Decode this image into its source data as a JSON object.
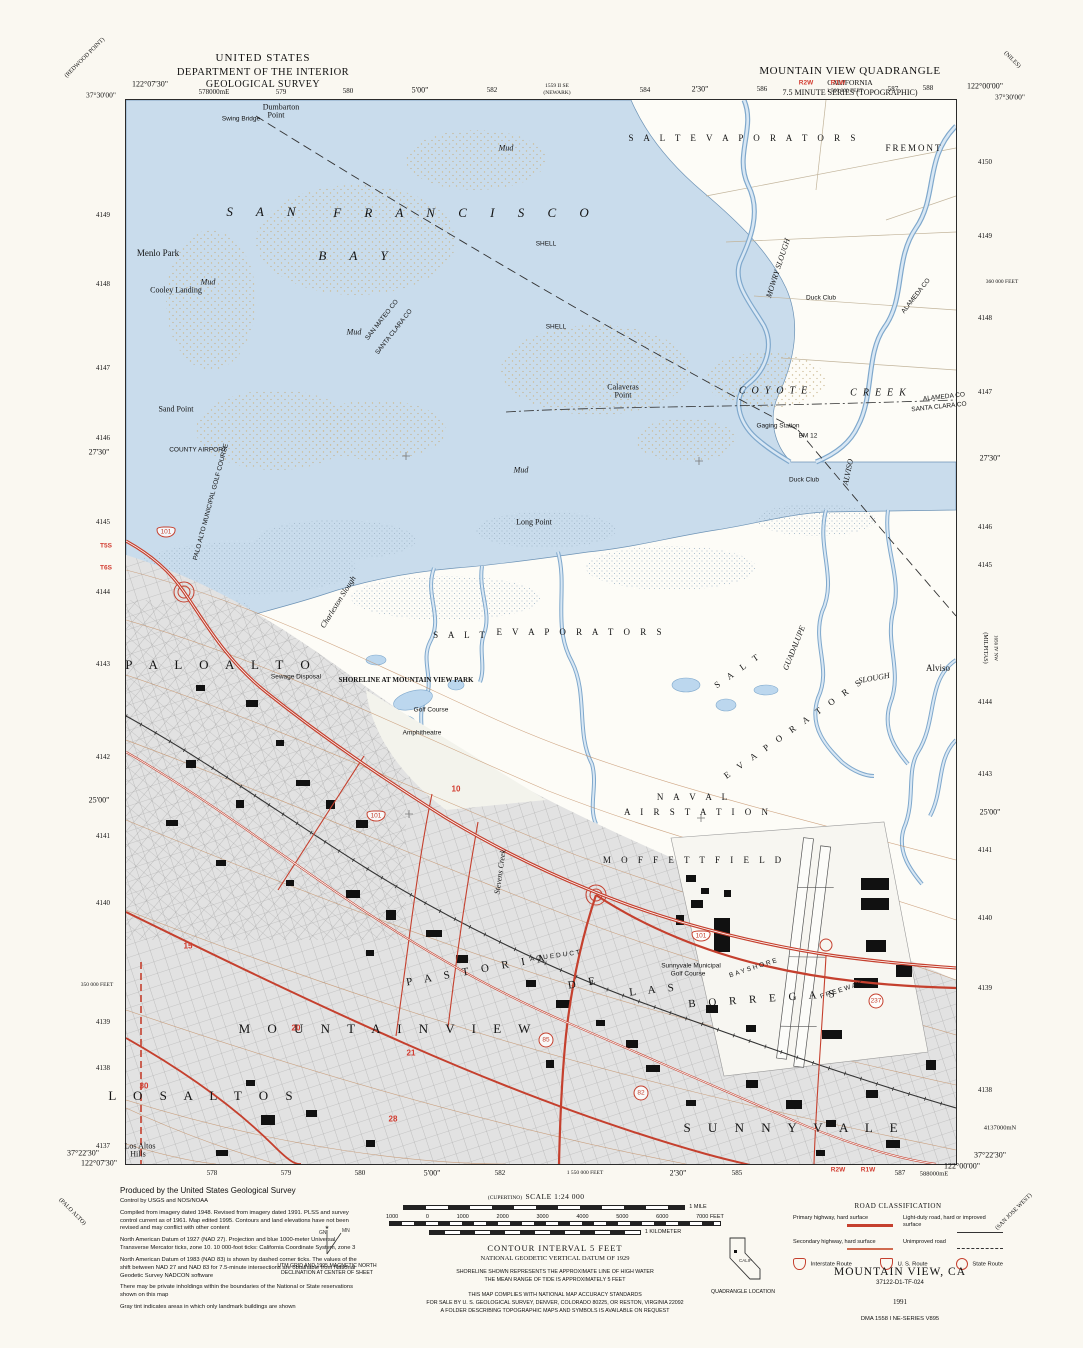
{
  "header": {
    "line1": "UNITED STATES",
    "line2": "DEPARTMENT OF THE INTERIOR",
    "line3": "GEOLOGICAL SURVEY"
  },
  "title_block": {
    "line1": "MOUNTAIN VIEW QUADRANGLE",
    "line2": "CALIFORNIA",
    "line3": "7.5 MINUTE SERIES (TOPOGRAPHIC)"
  },
  "colors": {
    "water": "#c9dcec",
    "marsh_dot": "#9fb4c8",
    "urban_tint": "#e2e2e2",
    "road_red": "#c5402e",
    "contour_brown": "#c08a5f",
    "label_red": "#d23b2f"
  },
  "margin_labels": [
    {
      "t": "122°07'30\"",
      "x": 150,
      "y": 84
    },
    {
      "t": "37°30'00\"",
      "x": 101,
      "y": 95,
      "s": 7.5
    },
    {
      "t": "578000mE",
      "x": 214,
      "y": 92,
      "s": 7
    },
    {
      "t": "579",
      "x": 281,
      "y": 92,
      "s": 7
    },
    {
      "t": "580",
      "x": 348,
      "y": 91,
      "s": 7
    },
    {
      "t": "5'00\"",
      "x": 420,
      "y": 90
    },
    {
      "t": "582",
      "x": 492,
      "y": 90,
      "s": 7
    },
    {
      "t": "1559 II SE",
      "x": 557,
      "y": 86,
      "s": 5.5
    },
    {
      "t": "(NEWARK)",
      "x": 557,
      "y": 93,
      "s": 5.5
    },
    {
      "t": "584",
      "x": 645,
      "y": 90,
      "s": 7
    },
    {
      "t": "2'30\"",
      "x": 700,
      "y": 89
    },
    {
      "t": "586",
      "x": 762,
      "y": 89,
      "s": 7
    },
    {
      "t": "R2W",
      "x": 806,
      "y": 83,
      "red": 1,
      "s": 6.5
    },
    {
      "t": "R1W",
      "x": 838,
      "y": 83,
      "red": 1,
      "s": 6.5
    },
    {
      "t": "1 560 000 FEET",
      "x": 845,
      "y": 91,
      "s": 5.5
    },
    {
      "t": "587",
      "x": 893,
      "y": 89,
      "s": 7
    },
    {
      "t": "588",
      "x": 928,
      "y": 88,
      "s": 7
    },
    {
      "t": "122°00'00\"",
      "x": 985,
      "y": 86
    },
    {
      "t": "37°30'00\"",
      "x": 1010,
      "y": 97,
      "s": 7.5
    },
    {
      "t": "4149",
      "x": 103,
      "y": 215,
      "s": 7
    },
    {
      "t": "4148",
      "x": 103,
      "y": 284,
      "s": 7
    },
    {
      "t": "4147",
      "x": 103,
      "y": 368,
      "s": 7
    },
    {
      "t": "4146",
      "x": 103,
      "y": 438,
      "s": 7
    },
    {
      "t": "27'30\"",
      "x": 99,
      "y": 452
    },
    {
      "t": "4145",
      "x": 103,
      "y": 522,
      "s": 7
    },
    {
      "t": "T5S",
      "x": 106,
      "y": 546,
      "red": 1,
      "s": 6.5
    },
    {
      "t": "T6S",
      "x": 106,
      "y": 568,
      "red": 1,
      "s": 6.5
    },
    {
      "t": "4144",
      "x": 103,
      "y": 592,
      "s": 7
    },
    {
      "t": "4143",
      "x": 103,
      "y": 664,
      "s": 7
    },
    {
      "t": "4142",
      "x": 103,
      "y": 757,
      "s": 7
    },
    {
      "t": "25'00\"",
      "x": 99,
      "y": 800
    },
    {
      "t": "4141",
      "x": 103,
      "y": 836,
      "s": 7
    },
    {
      "t": "4140",
      "x": 103,
      "y": 903,
      "s": 7
    },
    {
      "t": "350 000 FEET",
      "x": 97,
      "y": 985,
      "s": 5.5
    },
    {
      "t": "4139",
      "x": 103,
      "y": 1022,
      "s": 7
    },
    {
      "t": "4138",
      "x": 103,
      "y": 1068,
      "s": 7
    },
    {
      "t": "4137",
      "x": 103,
      "y": 1146,
      "s": 7
    },
    {
      "t": "37°22'30\"",
      "x": 83,
      "y": 1153
    },
    {
      "t": "122°07'30\"",
      "x": 99,
      "y": 1163
    },
    {
      "t": "4150",
      "x": 985,
      "y": 162,
      "s": 7
    },
    {
      "t": "4149",
      "x": 985,
      "y": 236,
      "s": 7
    },
    {
      "t": "360 000 FEET",
      "x": 1002,
      "y": 282,
      "s": 5.5
    },
    {
      "t": "4148",
      "x": 985,
      "y": 318,
      "s": 7
    },
    {
      "t": "4147",
      "x": 985,
      "y": 392,
      "s": 7
    },
    {
      "t": "27'30\"",
      "x": 990,
      "y": 458
    },
    {
      "t": "4146",
      "x": 985,
      "y": 527,
      "s": 7
    },
    {
      "t": "4145",
      "x": 985,
      "y": 565,
      "s": 7
    },
    {
      "t": "(MILPITAS)",
      "x": 985,
      "y": 648,
      "r": 90,
      "s": 6
    },
    {
      "t": "1656 IV NW",
      "x": 995,
      "y": 648,
      "r": 90,
      "s": 5
    },
    {
      "t": "4144",
      "x": 985,
      "y": 702,
      "s": 7
    },
    {
      "t": "4143",
      "x": 985,
      "y": 774,
      "s": 7
    },
    {
      "t": "25'00\"",
      "x": 990,
      "y": 812
    },
    {
      "t": "4141",
      "x": 985,
      "y": 850,
      "s": 7
    },
    {
      "t": "4140",
      "x": 985,
      "y": 918,
      "s": 7
    },
    {
      "t": "4139",
      "x": 985,
      "y": 988,
      "s": 7
    },
    {
      "t": "4138",
      "x": 985,
      "y": 1090,
      "s": 7
    },
    {
      "t": "4137000mN",
      "x": 1000,
      "y": 1128,
      "s": 6.5
    },
    {
      "t": "37°22'30\"",
      "x": 990,
      "y": 1155
    },
    {
      "t": "122°00'00\"",
      "x": 962,
      "y": 1166
    },
    {
      "t": "578",
      "x": 212,
      "y": 1173,
      "s": 7
    },
    {
      "t": "579",
      "x": 286,
      "y": 1173,
      "s": 7
    },
    {
      "t": "580",
      "x": 360,
      "y": 1173,
      "s": 7
    },
    {
      "t": "5'00\"",
      "x": 432,
      "y": 1173
    },
    {
      "t": "582",
      "x": 500,
      "y": 1173,
      "s": 7
    },
    {
      "t": "1 550 000 FEET",
      "x": 585,
      "y": 1173,
      "s": 5.5
    },
    {
      "t": "2'30\"",
      "x": 678,
      "y": 1173
    },
    {
      "t": "585",
      "x": 737,
      "y": 1173,
      "s": 7
    },
    {
      "t": "R2W",
      "x": 838,
      "y": 1170,
      "red": 1,
      "s": 6.5
    },
    {
      "t": "R1W",
      "x": 868,
      "y": 1170,
      "red": 1,
      "s": 6.5
    },
    {
      "t": "587",
      "x": 900,
      "y": 1173,
      "s": 7
    },
    {
      "t": "588000mE",
      "x": 934,
      "y": 1174,
      "s": 6.5
    },
    {
      "t": "(CUPERTINO)",
      "x": 505,
      "y": 1198,
      "s": 5.5
    },
    {
      "t": "(REDWOOD POINT)",
      "x": 85,
      "y": 58,
      "r": -45,
      "s": 6
    },
    {
      "t": "(NILES)",
      "x": 1012,
      "y": 60,
      "r": 45,
      "s": 6
    },
    {
      "t": "(SAN JOSE WEST)",
      "x": 1014,
      "y": 1212,
      "r": -45,
      "s": 6
    },
    {
      "t": "(PALO ALTO)",
      "x": 72,
      "y": 1212,
      "r": 45,
      "s": 6
    }
  ],
  "map_labels": [
    {
      "t": "Dumbarton",
      "x": 155,
      "y": 7,
      "c": "feat"
    },
    {
      "t": "Point",
      "x": 150,
      "y": 15,
      "c": "feat"
    },
    {
      "t": "Swing Bridge",
      "x": 115,
      "y": 19,
      "c": "tiny"
    },
    {
      "t": "S  A  N",
      "x": 140,
      "y": 112,
      "c": "sea"
    },
    {
      "t": "F  R  A  N  C  I  S  C  O",
      "x": 340,
      "y": 113,
      "c": "sea"
    },
    {
      "t": "B  A  Y",
      "x": 232,
      "y": 156,
      "c": "sea"
    },
    {
      "t": "Menlo Park",
      "x": 32,
      "y": 153,
      "c": "town"
    },
    {
      "t": "Cooley Landing",
      "x": 50,
      "y": 190,
      "c": "feat"
    },
    {
      "t": "Mud",
      "x": 82,
      "y": 182,
      "c": "wtr"
    },
    {
      "t": "Mud",
      "x": 380,
      "y": 48,
      "c": "wtr"
    },
    {
      "t": "Mud",
      "x": 228,
      "y": 232,
      "c": "wtr"
    },
    {
      "t": "Mud",
      "x": 395,
      "y": 370,
      "c": "wtr"
    },
    {
      "t": "SHELL",
      "x": 420,
      "y": 144,
      "c": "tiny"
    },
    {
      "t": "SHELL",
      "x": 430,
      "y": 227,
      "c": "tiny"
    },
    {
      "t": "S A L T    E V A P O R A T O R S",
      "x": 618,
      "y": 38,
      "c": "area"
    },
    {
      "t": "FREMONT",
      "x": 788,
      "y": 48,
      "c": "town2"
    },
    {
      "t": "MOWRY  SLOUGH",
      "x": 652,
      "y": 168,
      "c": "wtr",
      "r": -72
    },
    {
      "t": "Duck Club",
      "x": 695,
      "y": 198,
      "c": "tiny"
    },
    {
      "t": "COYOTE",
      "x": 650,
      "y": 291,
      "c": "creek"
    },
    {
      "t": "CREEK",
      "x": 755,
      "y": 293,
      "c": "creek"
    },
    {
      "t": "Calaveras",
      "x": 497,
      "y": 287,
      "c": "feat"
    },
    {
      "t": "Point",
      "x": 497,
      "y": 295,
      "c": "feat"
    },
    {
      "t": "ALAMEDA  CO",
      "x": 818,
      "y": 297,
      "c": "tiny",
      "r": -6
    },
    {
      "t": "SANTA CLARA  CO",
      "x": 813,
      "y": 307,
      "c": "tiny",
      "r": -6
    },
    {
      "t": "ALAMEDA CO",
      "x": 790,
      "y": 196,
      "c": "tiny",
      "r": -52
    },
    {
      "t": "SAN MATEO CO",
      "x": 256,
      "y": 220,
      "c": "tiny",
      "r": -52
    },
    {
      "t": "SANTA CLARA CO",
      "x": 268,
      "y": 232,
      "c": "tiny",
      "r": -52
    },
    {
      "t": "Gaging Station",
      "x": 652,
      "y": 326,
      "c": "tiny"
    },
    {
      "t": "BM 12",
      "x": 682,
      "y": 336,
      "c": "tiny"
    },
    {
      "t": "Duck Club",
      "x": 678,
      "y": 380,
      "c": "tiny"
    },
    {
      "t": "ALVISO",
      "x": 722,
      "y": 372,
      "c": "wtr",
      "r": -78
    },
    {
      "t": "Long Point",
      "x": 408,
      "y": 422,
      "c": "feat"
    },
    {
      "t": "Sand Point",
      "x": 50,
      "y": 309,
      "c": "feat"
    },
    {
      "t": "COUNTY AIRPORT",
      "x": 72,
      "y": 350,
      "c": "tiny"
    },
    {
      "t": "PALO ALTO MUNICIPAL GOLF COURSE",
      "x": 85,
      "y": 402,
      "c": "tiny",
      "r": -75
    },
    {
      "t": "Charleston Slough",
      "x": 212,
      "y": 502,
      "c": "wtr",
      "r": -58
    },
    {
      "t": "S A L T",
      "x": 335,
      "y": 535,
      "c": "area"
    },
    {
      "t": "E V A P O R A T O R S",
      "x": 455,
      "y": 532,
      "c": "area"
    },
    {
      "t": "S A L T",
      "x": 612,
      "y": 570,
      "c": "area",
      "r": -35
    },
    {
      "t": "E V A P O R A T O R S",
      "x": 668,
      "y": 628,
      "c": "area",
      "r": -35
    },
    {
      "t": "GUADALUPE",
      "x": 668,
      "y": 548,
      "c": "wtr",
      "r": -68
    },
    {
      "t": "SLOUGH",
      "x": 748,
      "y": 578,
      "c": "wtr",
      "r": -10
    },
    {
      "t": "Alviso",
      "x": 812,
      "y": 568,
      "c": "town"
    },
    {
      "t": "P A L O   A L T O",
      "x": 95,
      "y": 565,
      "c": "big"
    },
    {
      "t": "Sewage Disposal",
      "x": 170,
      "y": 577,
      "c": "tiny"
    },
    {
      "t": "SHORELINE AT MOUNTAIN VIEW PARK",
      "x": 280,
      "y": 580,
      "c": "note"
    },
    {
      "t": "Golf Course",
      "x": 305,
      "y": 610,
      "c": "tiny"
    },
    {
      "t": "Amphitheatre",
      "x": 296,
      "y": 633,
      "c": "tiny"
    },
    {
      "t": "N A V A L",
      "x": 568,
      "y": 697,
      "c": "area"
    },
    {
      "t": "A I R   S T A T I O N",
      "x": 572,
      "y": 712,
      "c": "area"
    },
    {
      "t": "M O F F E T T   F I E L D",
      "x": 568,
      "y": 760,
      "c": "area"
    },
    {
      "t": "P A S T O R I A",
      "x": 352,
      "y": 870,
      "c": "grant",
      "r": -10
    },
    {
      "t": "D E",
      "x": 458,
      "y": 883,
      "c": "grant",
      "r": -10
    },
    {
      "t": "L A S",
      "x": 528,
      "y": 890,
      "c": "grant",
      "r": -6
    },
    {
      "t": "B O R R E G A S",
      "x": 638,
      "y": 899,
      "c": "grant",
      "r": -4
    },
    {
      "t": "Sunnyvale Municipal",
      "x": 565,
      "y": 866,
      "c": "tiny"
    },
    {
      "t": "Golf Course",
      "x": 562,
      "y": 874,
      "c": "tiny"
    },
    {
      "t": "M O U N T A I N   V I E W",
      "x": 262,
      "y": 929,
      "c": "big"
    },
    {
      "t": "L O S   A L T O S",
      "x": 78,
      "y": 996,
      "c": "big"
    },
    {
      "t": "S U N N Y V A L E",
      "x": 668,
      "y": 1028,
      "c": "big"
    },
    {
      "t": "BAYSHORE",
      "x": 628,
      "y": 868,
      "c": "rd",
      "r": -18
    },
    {
      "t": "FREEWAY",
      "x": 716,
      "y": 890,
      "c": "rd",
      "r": -18
    },
    {
      "t": "AQUEDUCT",
      "x": 430,
      "y": 856,
      "c": "rd",
      "r": -8
    },
    {
      "t": "Stevens Creek",
      "x": 374,
      "y": 772,
      "c": "wtr",
      "r": -82
    },
    {
      "t": "Los Altos",
      "x": 14,
      "y": 1046,
      "c": "feat"
    },
    {
      "t": "Hills",
      "x": 12,
      "y": 1054,
      "c": "feat"
    }
  ],
  "route_markers": [
    {
      "type": "us",
      "label": "101",
      "x": 40,
      "y": 432
    },
    {
      "type": "us",
      "label": "101",
      "x": 250,
      "y": 716
    },
    {
      "type": "us",
      "label": "101",
      "x": 575,
      "y": 836
    },
    {
      "type": "state",
      "label": "237",
      "x": 750,
      "y": 901
    },
    {
      "type": "state",
      "label": "85",
      "x": 420,
      "y": 940
    },
    {
      "type": "state",
      "label": "82",
      "x": 515,
      "y": 993
    },
    {
      "type": "sec",
      "label": "10",
      "x": 330,
      "y": 689
    },
    {
      "type": "sec",
      "label": "15",
      "x": 62,
      "y": 846
    },
    {
      "type": "sec",
      "label": "20",
      "x": 170,
      "y": 928
    },
    {
      "type": "sec",
      "label": "21",
      "x": 285,
      "y": 953
    },
    {
      "type": "sec",
      "label": "28",
      "x": 267,
      "y": 1019
    },
    {
      "type": "sec",
      "label": "30",
      "x": 18,
      "y": 986
    }
  ],
  "notes": {
    "produced_by": "Produced by the United States Geological Survey",
    "credits": [
      "Control by USGS and NOS/NOAA",
      "Compiled from imagery dated 1948. Revised from imagery dated 1991. PLSS and survey control current as of 1961. Map edited 1995. Contours and land elevations have not been revised and may conflict with other content",
      "North American Datum of 1927 (NAD 27). Projection and blue 1000-meter Universal Transverse Mercator ticks, zone 10. 10 000-foot ticks: California Coordinate System, zone 3",
      "North American Datum of 1983 (NAD 83) is shown by dashed corner ticks. The values of the shift between NAD 27 and NAD 83 for 7.5-minute intersections are obtainable from National Geodetic Survey NADCON software",
      "There may be private inholdings within the boundaries of the National or State reservations shown on this map",
      "Gray tint indicates areas in which only landmark buildings are shown"
    ]
  },
  "scale": {
    "title": "SCALE 1:24 000",
    "mile_label": "1 MILE",
    "feet_ticks": [
      "1000",
      "0",
      "1000",
      "2000",
      "3000",
      "4000",
      "5000",
      "6000",
      "7000 FEET"
    ],
    "km_label": "1 KILOMETER",
    "contour": "CONTOUR INTERVAL 5 FEET",
    "datum": "NATIONAL GEODETIC VERTICAL DATUM OF 1929",
    "shoreline1": "SHORELINE SHOWN REPRESENTS THE APPROXIMATE LINE OF HIGH WATER",
    "shoreline2": "THE MEAN RANGE OF TIDE IS APPROXIMATELY 5 FEET",
    "compliance1": "THIS MAP COMPLIES WITH NATIONAL MAP ACCURACY STANDARDS",
    "compliance2": "FOR SALE BY U. S. GEOLOGICAL SURVEY, DENVER, COLORADO 80225, OR RESTON, VIRGINIA 22092",
    "compliance3": "A FOLDER DESCRIBING TOPOGRAPHIC MAPS AND SYMBOLS IS AVAILABLE ON REQUEST"
  },
  "declination": {
    "gn": "GN",
    "mn": "MN",
    "caption1": "UTM GRID AND 1995 MAGNETIC NORTH",
    "caption2": "DECLINATION AT CENTER OF SHEET"
  },
  "road_classification": {
    "title": "ROAD CLASSIFICATION",
    "rows": [
      {
        "label": "Primary highway, hard surface",
        "style": "primary"
      },
      {
        "label": "Secondary highway, hard surface",
        "style": "secondary"
      },
      {
        "label": "Light-duty road, hard or improved surface",
        "style": "light"
      },
      {
        "label": "Unimproved road",
        "style": "unimproved"
      }
    ],
    "shields": [
      {
        "label": "Interstate Route",
        "shape": "interstate"
      },
      {
        "label": "U. S. Route",
        "shape": "us"
      },
      {
        "label": "State Route",
        "shape": "state"
      }
    ]
  },
  "quadrangle_location": {
    "label": "QUADRANGLE LOCATION",
    "state_abbr": "CALIF"
  },
  "map_id": {
    "name": "MOUNTAIN VIEW, CA",
    "id": "37122-D1-TF-024",
    "year": "1991",
    "series": "DMA 1558 I NE-SERIES V895"
  }
}
